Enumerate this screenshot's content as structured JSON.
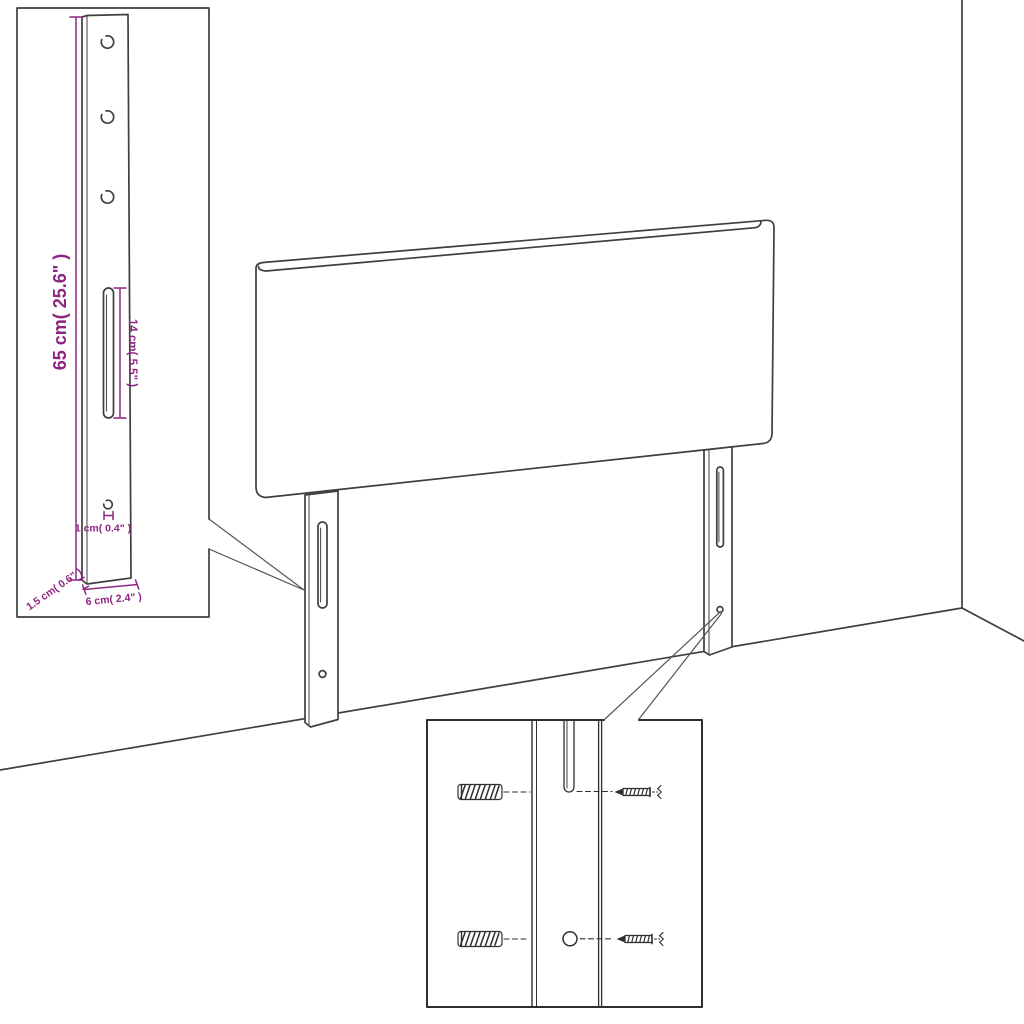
{
  "scene": {
    "type": "furniture assembly line drawing",
    "subject": "upholstered headboard with two wall-mounting legs shown against a room corner, with a dimensioned detail view of one leg and a close-up inset of the wall-plug and screw fixing points"
  },
  "dimension_labels": {
    "leg_height": "65 cm( 25.6\" )",
    "slot_length": "14 cm( 5.5\" )",
    "bottom_hole": "1 cm( 0.4\" )",
    "leg_thickness": "1.5 cm( 0.6\" )",
    "leg_width": "6 cm( 2.4\" )"
  },
  "counts": {
    "detail_leg_top_holes": 3,
    "mounting_legs": 2,
    "inset_wall_plugs": 2,
    "inset_screws": 2
  },
  "colors": {
    "line": "#3f3f3f",
    "inset_line": "#2e2e2e",
    "dimension": "#8D2680",
    "background": "#ffffff"
  }
}
